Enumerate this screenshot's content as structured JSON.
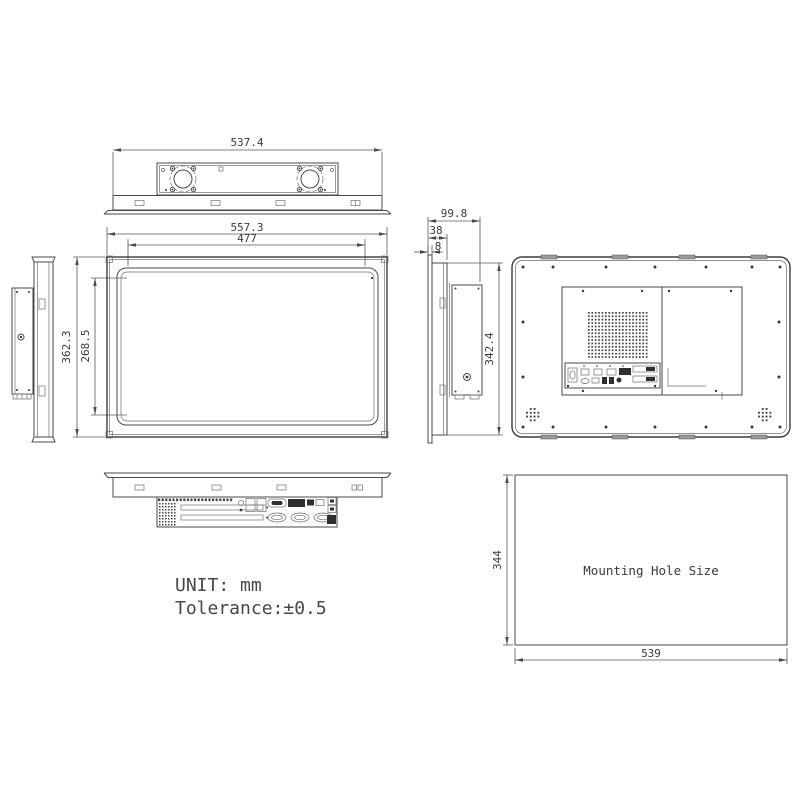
{
  "notes": {
    "unit": "UNIT: mm",
    "tolerance": "Tolerance:±0.5"
  },
  "top_view": {
    "width_mm": "537.4"
  },
  "front_view": {
    "outer_width_mm": "557.3",
    "display_width_mm": "477",
    "outer_height_mm": "362.3",
    "display_height_mm": "268.5"
  },
  "side_view": {
    "total_depth_mm": "99.8",
    "bezel_depth_mm": "38",
    "front_lip_mm": "8",
    "rear_height_mm": "342.4"
  },
  "mounting_view": {
    "label": "Mounting Hole Size",
    "height_mm": "344",
    "width_mm": "539"
  }
}
